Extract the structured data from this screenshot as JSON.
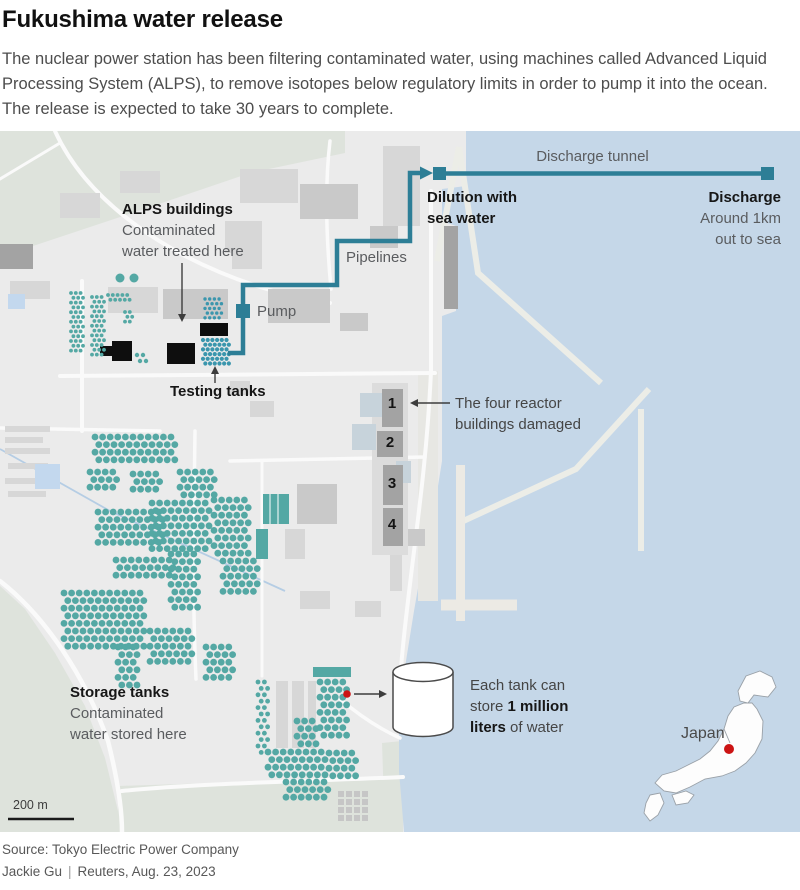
{
  "header": {
    "title": "Fukushima water release",
    "intro": "The nuclear power station has been filtering contaminated water, using machines called Advanced Liquid Processing System (ALPS), to remove isotopes below regulatory limits in order to pump it into the ocean. The release is expected to take 30 years to complete."
  },
  "map": {
    "labels": {
      "discharge_tunnel": "Discharge tunnel",
      "dilution_line1": "Dilution with",
      "dilution_line2": "sea water",
      "discharge": "Discharge",
      "discharge_sub1": "Around 1km",
      "discharge_sub2": "out to sea",
      "pipelines": "Pipelines",
      "pump": "Pump",
      "alps_title": "ALPS buildings",
      "alps_sub1": "Contaminated",
      "alps_sub2": "water treated here",
      "testing_tanks": "Testing tanks",
      "reactors_note_line1": "The four reactor",
      "reactors_note_line2": "buildings damaged",
      "storage_title": "Storage tanks",
      "storage_sub1": "Contaminated",
      "storage_sub2": "water stored here",
      "tank_note_line1": "Each tank can",
      "tank_note_line2_pre": "store ",
      "tank_note_line2_bold": "1 million",
      "tank_note_line3_bold": "liters",
      "tank_note_line3_post": " of water",
      "japan": "Japan",
      "scale": "200 m"
    },
    "reactors": [
      "1",
      "2",
      "3",
      "4"
    ],
    "colors": {
      "sea": "#c5d7e8",
      "land": "#ebebeb",
      "terrain_green": "#dee3dc",
      "tank_teal": "#54a8a4",
      "testing_tank_teal": "#3b96ad",
      "pipeline": "#2d7e96",
      "reactor_gray": "#a3a3a3",
      "alps_black": "#0e0e0e",
      "red_dot": "#cc1414"
    }
  },
  "footer": {
    "source": "Source: Tokyo Electric Power Company",
    "byline": "Jackie Gu",
    "separator": "|",
    "credit": "Reuters, Aug. 23, 2023"
  }
}
